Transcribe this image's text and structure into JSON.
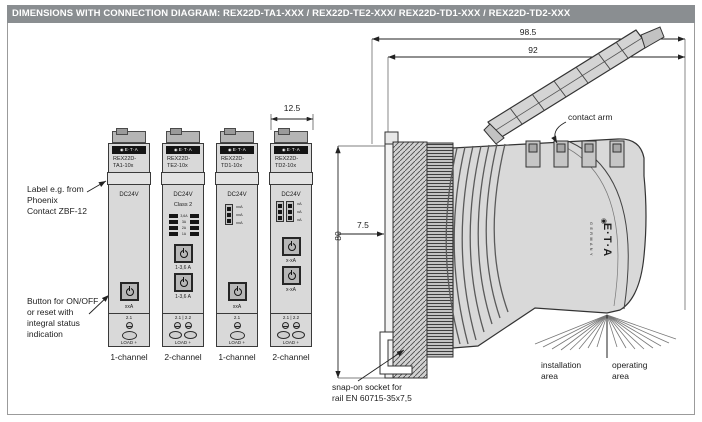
{
  "colors": {
    "header_bg": "#8a8e91",
    "header_text": "#ffffff",
    "line_color": "#333333",
    "body_fill": "#d9d9d9"
  },
  "icons": {
    "logo_dot": "◉"
  },
  "header": {
    "title": "DIMENSIONS WITH CONNECTION DIAGRAM: REX22D-TA1-XXX / REX22D-TE2-XXX/ REX22D-TD1-XXX / REX22D-TD2-XXX"
  },
  "notes": {
    "label_note": "Label e.g. from\nPhoenix\nContact ZBF-12",
    "button_note": "Button for ON/OFF\nor reset with\nintegral status\nindication"
  },
  "dims": {
    "overall_depth": "98.5",
    "housing_depth": "92",
    "height": "80",
    "rail_offset": "7.5",
    "module_width": "12.5"
  },
  "modules": [
    {
      "brand": "E·T·A",
      "model_line1": "REX22D-",
      "model_line2": "TA1-10x",
      "voltage": "DC24V",
      "button_label": "xxA",
      "terminal_label": "2.1",
      "load_label": "LOAD +",
      "channel": "1-channel"
    },
    {
      "brand": "E·T·A",
      "model_line1": "REX22D-",
      "model_line2": "TE2-10x",
      "voltage": "DC24V",
      "class_label": "Class 2",
      "dip_labels": [
        "3,6A",
        "3A",
        "2A",
        "1A"
      ],
      "selector_label": "1-3,6 A",
      "button_label": "1-3,6 A",
      "terminal_label": "2.1 | 2.2",
      "load_label": "LOAD +",
      "channel": "2-channel"
    },
    {
      "brand": "E·T·A",
      "model_line1": "REX22D-",
      "model_line2": "TD1-10x",
      "voltage": "DC24V",
      "dip_labels": [
        "xxA",
        "xxA",
        "xxA"
      ],
      "button_label": "xxA",
      "terminal_label": "2.1",
      "load_label": "LOAD +",
      "channel": "1-channel"
    },
    {
      "brand": "E·T·A",
      "model_line1": "REX22D-",
      "model_line2": "TD2-10x",
      "voltage": "DC24V",
      "dip_labels": [
        "xA",
        "xA",
        "xA"
      ],
      "selector_label": "x-xA",
      "button_label": "x-xA",
      "terminal_label": "2.1 | 2.2",
      "load_label": "LOAD +",
      "channel": "2-channel"
    }
  ],
  "side": {
    "contact_arm": "contact arm",
    "snap_line1": "snap-on socket for",
    "snap_line2": "rail EN 60715-35x7,5",
    "install_line1": "installation",
    "install_line2": "area",
    "operate_line1": "operating",
    "operate_line2": "area",
    "brand": "E·T·A",
    "country": "GERMANY"
  }
}
